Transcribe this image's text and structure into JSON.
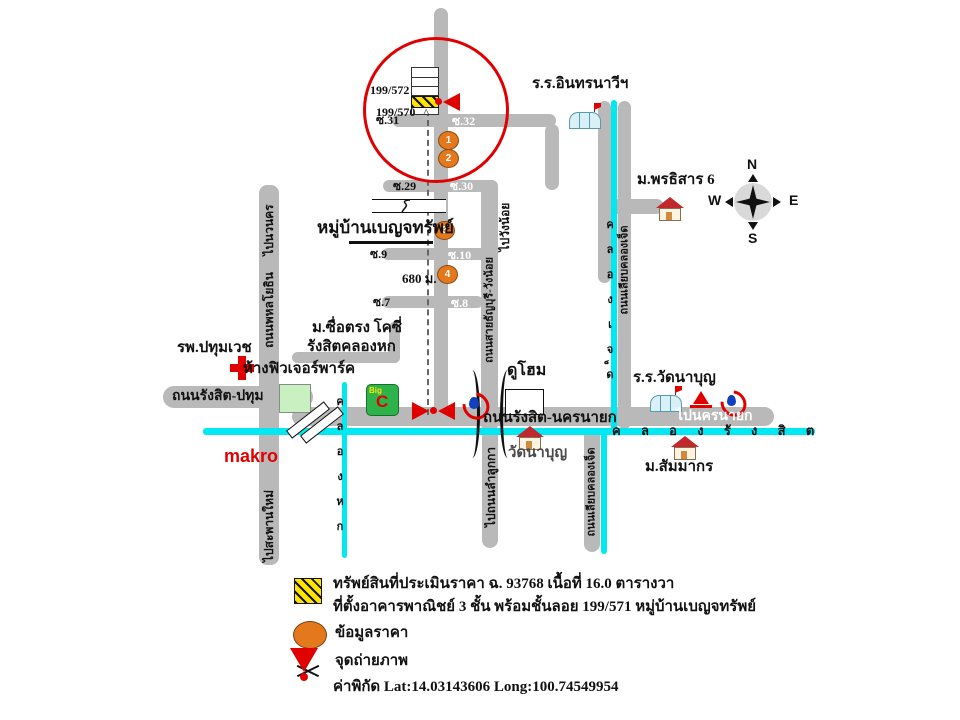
{
  "colors": {
    "road_gray": "#b9b9b9",
    "canal_cyan": "#00e9f2",
    "marker_orange": "#e4781c",
    "highlight_red": "#e10000",
    "hatch_yellow": "#ffe400",
    "bigc_green": "#2db34a"
  },
  "units": {
    "top": "199/572",
    "bottom": "199/570",
    "caret": "^"
  },
  "sois": {
    "s31": "ซ.31",
    "s32": "ซ.32",
    "s29": "ซ.29",
    "s30": "ซ.30",
    "s9": "ซ.9",
    "s10": "ซ.10",
    "s7": "ซ.7",
    "s8": "ซ.8"
  },
  "village_name": "หมู่บ้านเบญจทรัพย์",
  "distance": "680 ม.",
  "roads": {
    "phahonyothin": "ถนนพหลโยธิน",
    "to_navanakorn": "ไปนวนคร",
    "to_saphanmai": "ไปสะพานใหม่",
    "rangsit_pathum": "ถนนรังสิต-ปทุม",
    "rangsit_nakhonnayok": "ถนนรังสิต-นครนายก",
    "to_nakhonnayok": "ไปนครนายก",
    "thanyaburi_wangnoi": "ถนนสายธัญบุรี-วังน้อย",
    "to_wangnoi": "ไปวังน้อย",
    "liap_khlong7_north": "ถนนเลียบคลองเจ็ด",
    "liap_khlong7_south": "ถนนเลียบคลองเจ็ด",
    "to_lamlukka": "ไปถนนลำลูกกา"
  },
  "canals": {
    "khlong_rangsit": "ค ล อ ง รั ง สิ ต",
    "khlong6": "คลองหก",
    "khlong7": "คลองเจ็ด"
  },
  "places": {
    "school_inthara": "ร.ร.อินทรนาวีฯ",
    "m_porntisan": "ม.พรธิสาร 6",
    "hospital": "รพ.ปทุมเวช",
    "future_park": "ห้างฟิวเจอร์พาร์ค",
    "suetrong_line1": "ม.ซื่อตรง โคซี่",
    "suetrong_line2": "รังสิตคลองหก",
    "makro": "makro",
    "duhome": "ดูโฮม",
    "wat_nabun": "วัดนาบุญ",
    "school_watnabun": "ร.ร.วัดนาบุญ",
    "m_sammakorn": "ม.สัมมากร"
  },
  "markers": [
    "1",
    "2",
    "3",
    "4"
  ],
  "compass": {
    "n": "N",
    "e": "E",
    "s": "S",
    "w": "W"
  },
  "icons": {
    "big_c_word": "Big",
    "big_c_letter": "C"
  },
  "legend": {
    "line1": "ทรัพย์สินที่ประเมินราคา ฉ. 93768 เนื้อที่ 16.0 ตารางวา",
    "line2": "ที่ตั้งอาคารพาณิชย์ 3 ชั้น พร้อมชั้นลอย 199/571  หมู่บ้านเบญจทรัพย์",
    "price_info": "ข้อมูลราคา",
    "photo_point": "จุดถ่ายภาพ",
    "coordinates": "ค่าพิกัด Lat:14.03143606 Long:100.74549954"
  }
}
